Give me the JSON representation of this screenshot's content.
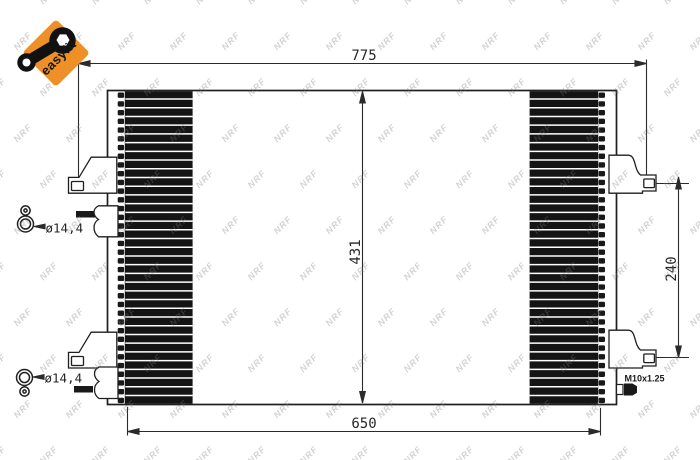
{
  "logo": {
    "text": "easyfit",
    "background_color": "#EF8F28"
  },
  "watermark": {
    "text": "NRF"
  },
  "drawing": {
    "line_color": "#1f1f1f",
    "dimensions": {
      "overall_width": "775",
      "core_height": "431",
      "right_bracket_spacing": "240",
      "core_width": "650"
    },
    "labels": {
      "upper_port_diameter": "ø14,4",
      "lower_port_diameter": "ø14,4",
      "thread_size": "M10x1.25"
    }
  }
}
